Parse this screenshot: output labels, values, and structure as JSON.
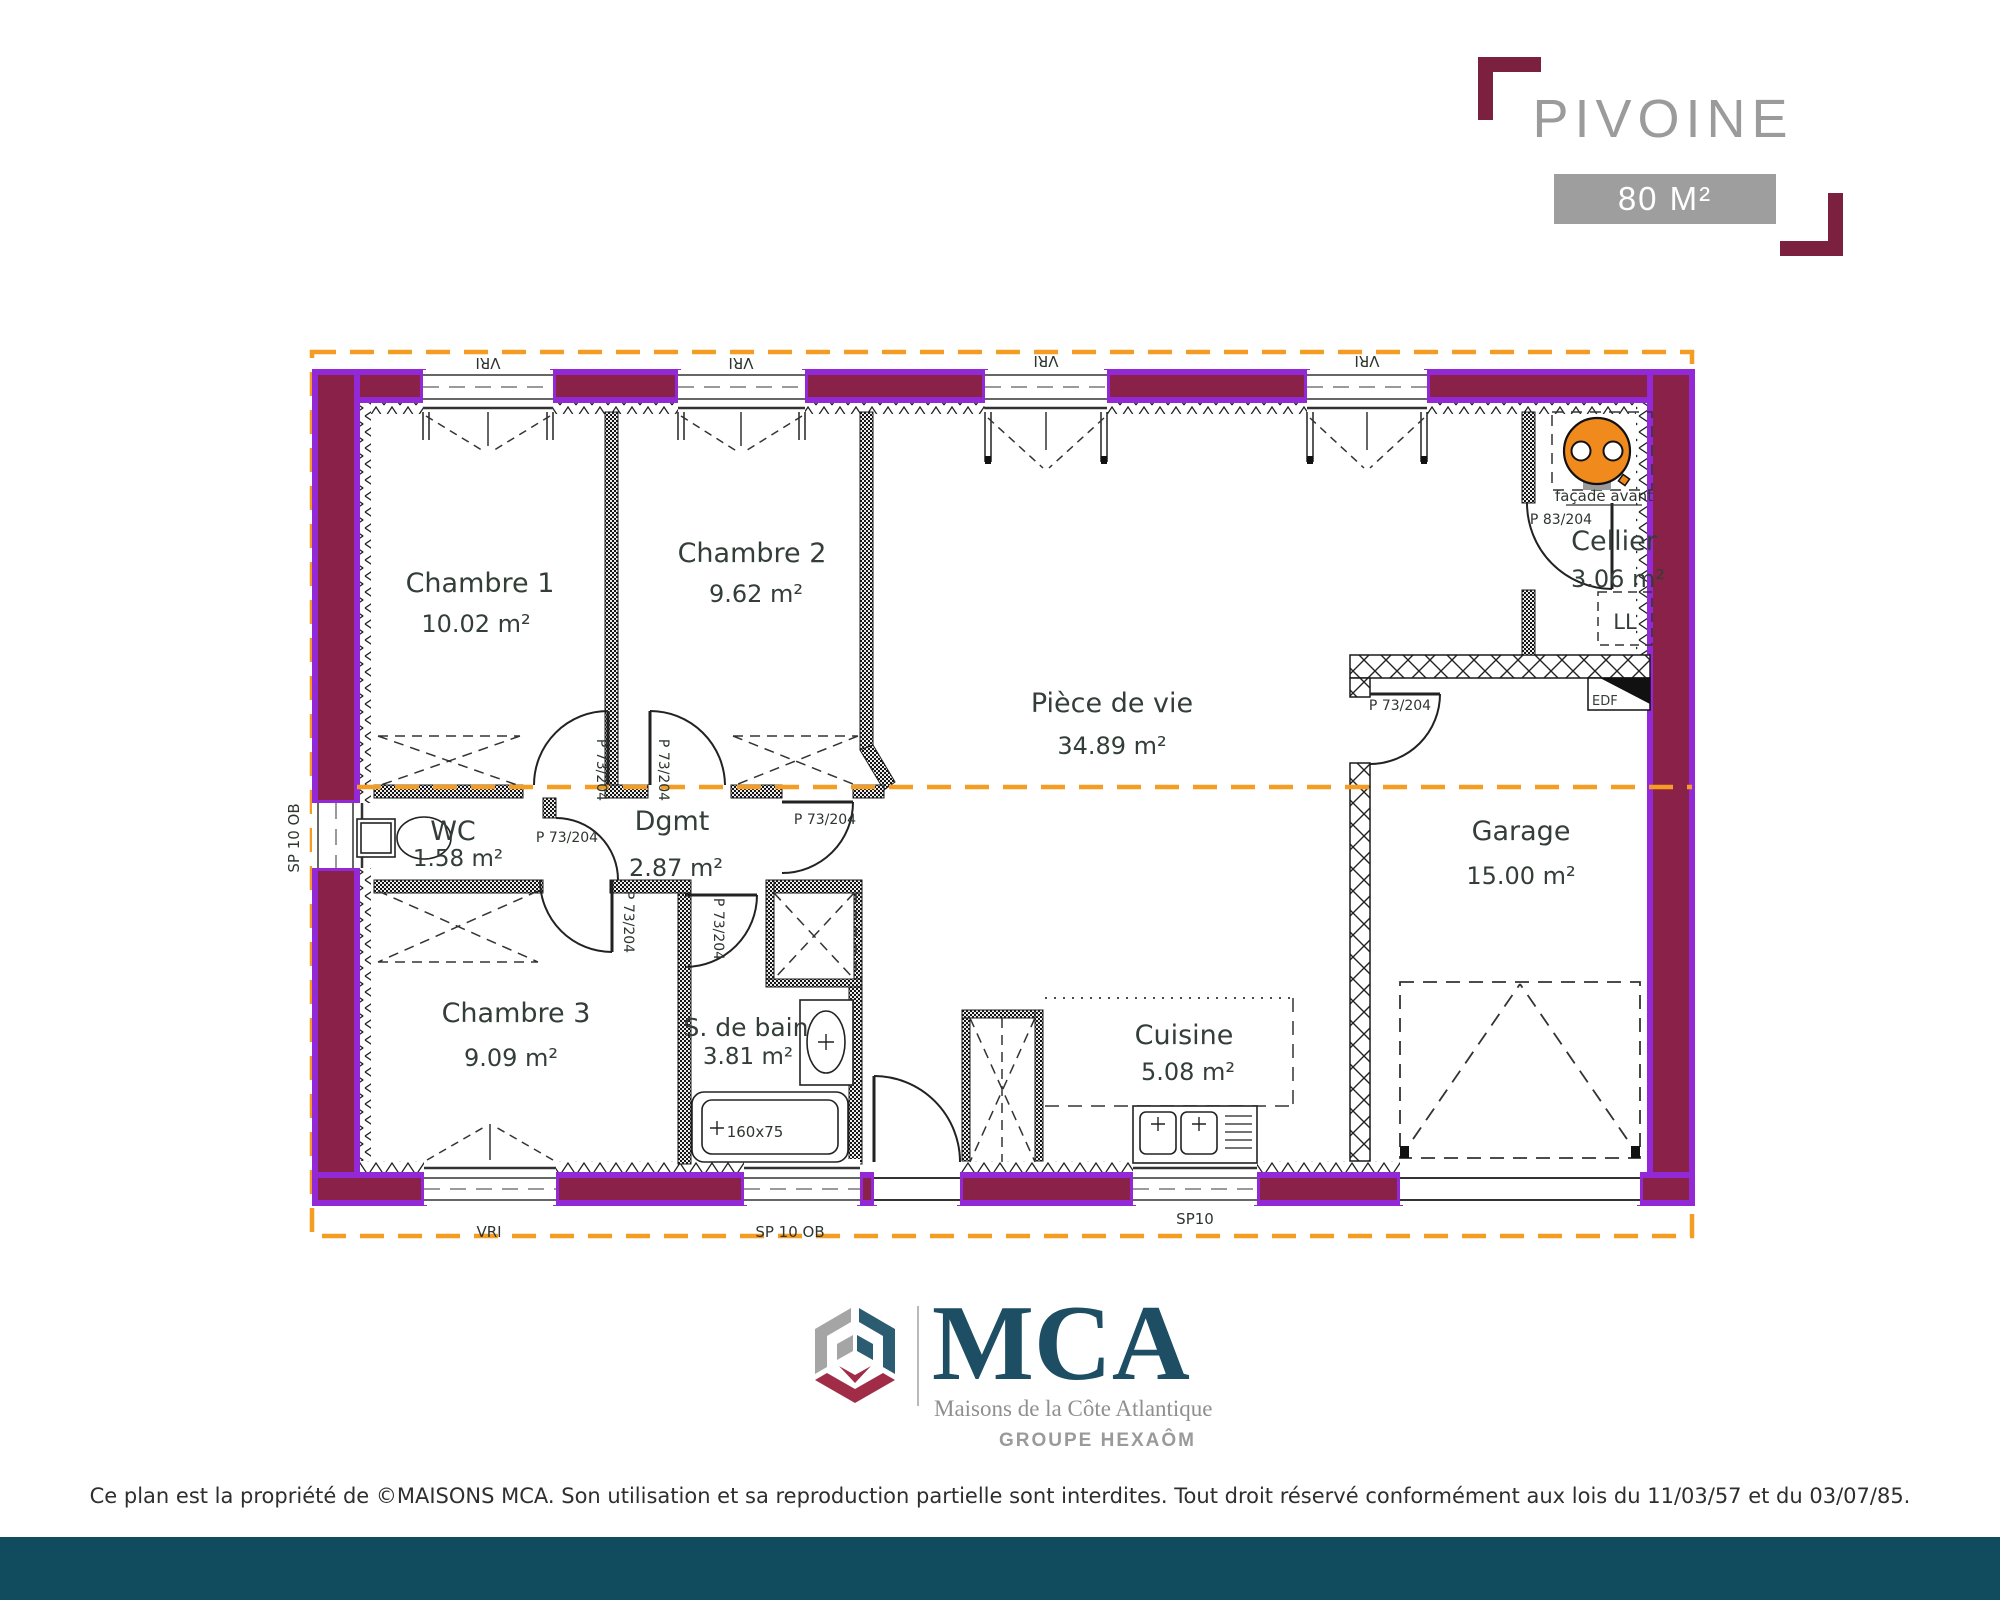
{
  "header": {
    "title": "PIVOINE",
    "area_badge": "80 M²"
  },
  "plan": {
    "rooms": [
      {
        "id": "chambre1",
        "name": "Chambre 1",
        "area": "10.02 m²"
      },
      {
        "id": "chambre2",
        "name": "Chambre 2",
        "area": "9.62 m²"
      },
      {
        "id": "piece_de_vie",
        "name": "Pièce de vie",
        "area": "34.89 m²"
      },
      {
        "id": "cellier",
        "name": "Cellier",
        "area": "3.06 m²"
      },
      {
        "id": "wc",
        "name": "WC",
        "area": "1.58 m²"
      },
      {
        "id": "dgmt",
        "name": "Dgmt",
        "area": "2.87 m²"
      },
      {
        "id": "chambre3",
        "name": "Chambre 3",
        "area": "9.09 m²"
      },
      {
        "id": "sdb",
        "name": "S. de bain",
        "area": "3.81 m²"
      },
      {
        "id": "cuisine",
        "name": "Cuisine",
        "area": "5.08 m²"
      },
      {
        "id": "garage",
        "name": "Garage",
        "area": "15.00 m²"
      }
    ],
    "labels": {
      "vri": "VRI",
      "sp10ob": "SP 10 OB",
      "sp10": "SP10",
      "p73": "P 73/204",
      "p83": "P 83/204",
      "ll": "LL",
      "edf": "EDF",
      "tub_size": "160x75",
      "facade": "façade avant"
    }
  },
  "branding": {
    "name": "MCA",
    "subtitle": "Maisons de la Côte Atlantique",
    "group": "GROUPE HEXAÔM"
  },
  "footer": {
    "copyright": "Ce plan est la propriété de ©MAISONS MCA. Son utilisation et sa reproduction partielle sont interdites. Tout droit réservé conformément aux lois du 11/03/57 et du 03/07/85."
  },
  "colors": {
    "wall_fill": "#8a2149",
    "wall_stroke": "#9329d6",
    "boundary_orange": "#f59d22",
    "bracket": "#7c2040",
    "badge_bg": "#9e9e9e",
    "title_gray": "#9b9b9b",
    "logo_teal": "#1d4e63",
    "band_teal": "#114b5e",
    "unit_orange": "#f08a1d"
  }
}
